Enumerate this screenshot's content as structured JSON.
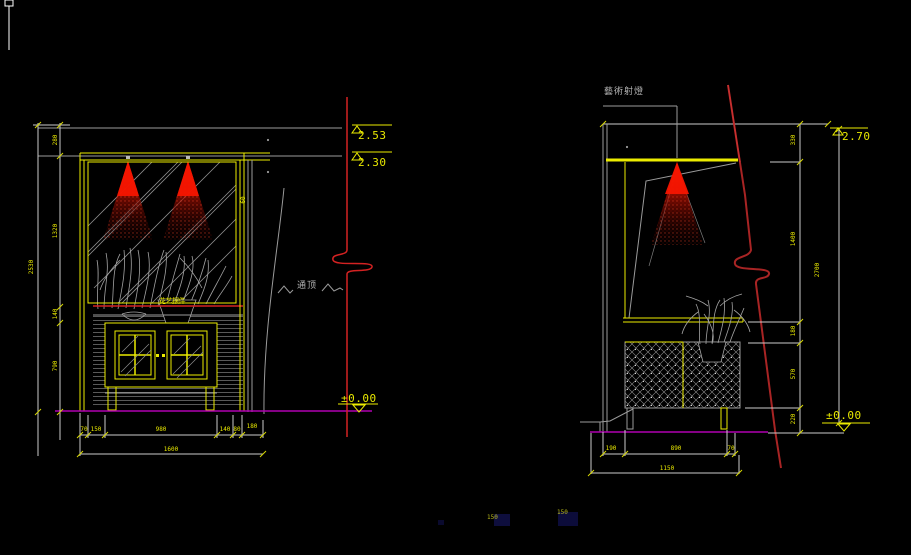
{
  "app": {
    "background": "#000000"
  },
  "colors": {
    "line_gray": "#9b9b9b",
    "dim_line": "#cdcdcd",
    "accent_yellow": "#ecec00",
    "text_yellow": "#e8e800",
    "red_break_line": "#d42222",
    "red_section_line": "#a82424",
    "spotlight_red": "#ff2000",
    "floor_magenta": "#b000b0",
    "plant_gray": "#a3a3a3",
    "note_gray": "#b5b5b5"
  },
  "left_view": {
    "level_253": "2.53",
    "level_230": "2.30",
    "level_000": "±0.00",
    "h_dims": [
      "280",
      "1320",
      "140",
      "790"
    ],
    "h_total": "2530",
    "w_dims": [
      "70",
      "150",
      "980",
      "140",
      "80",
      "180"
    ],
    "w_total": "1600",
    "side_dim": "60",
    "decor_label": "花艺摆件",
    "wall_note": "通顶"
  },
  "right_view": {
    "level_270": "2.70",
    "level_000": "±0.00",
    "spotlight_label": "藝術射燈",
    "h_dims": [
      "330",
      "1400",
      "180",
      "570",
      "220"
    ],
    "h_total": "2700",
    "w_dims": [
      "190",
      "890",
      "70"
    ],
    "w_total": "1150"
  },
  "footer": {
    "note_1": "150",
    "note_2": "150"
  }
}
